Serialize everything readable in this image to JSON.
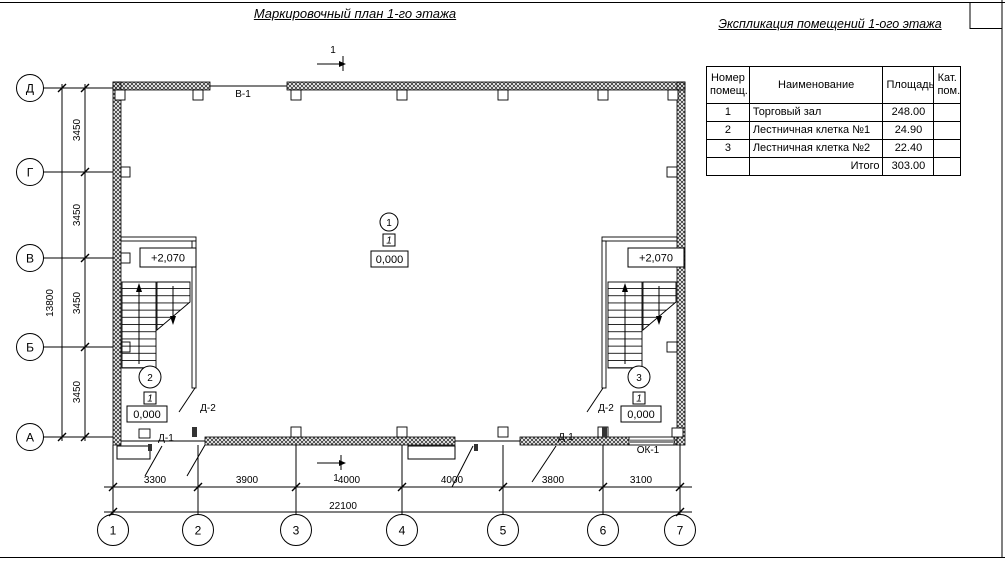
{
  "plan": {
    "title": "Маркировочный план 1-го этажа",
    "section_label": "1",
    "row_axes": [
      "Д",
      "Г",
      "В",
      "Б",
      "А"
    ],
    "col_axes": [
      "1",
      "2",
      "3",
      "4",
      "5",
      "6",
      "7"
    ],
    "dims_left": [
      "3450",
      "3450",
      "3450",
      "3450"
    ],
    "dim_left_total": "13800",
    "dims_bottom": [
      "3300",
      "3900",
      "4000",
      "4000",
      "3800",
      "3100"
    ],
    "dim_bottom_total": "22100",
    "rooms": [
      {
        "num": "1",
        "type": "1",
        "level": "0,000"
      },
      {
        "num": "2",
        "type": "1",
        "level": "0,000"
      },
      {
        "num": "3",
        "type": "1",
        "level": "0,000"
      }
    ],
    "elevations": [
      "+2,070",
      "+2,070"
    ],
    "labels": {
      "gate": "В-1",
      "entry_door_1": "Д-1",
      "entry_door_2": "Д-1",
      "stair_door_left": "Д-2",
      "stair_door_right": "Д-2",
      "window": "ОК-1"
    }
  },
  "schedule": {
    "title": "Экспликация помещений 1-ого этажа",
    "headers": {
      "num": "Номер помещ.",
      "name": "Наименование",
      "area": "Площадь",
      "cat": "Кат. пом."
    },
    "rows": [
      {
        "num": "1",
        "name": "Торговый зал",
        "area": "248.00",
        "cat": ""
      },
      {
        "num": "2",
        "name": "Лестничная клетка №1",
        "area": "24.90",
        "cat": ""
      },
      {
        "num": "3",
        "name": "Лестничная клетка №2",
        "area": "22.40",
        "cat": ""
      },
      {
        "num": "",
        "name": "Итого",
        "area": "303.00",
        "cat": ""
      }
    ]
  }
}
